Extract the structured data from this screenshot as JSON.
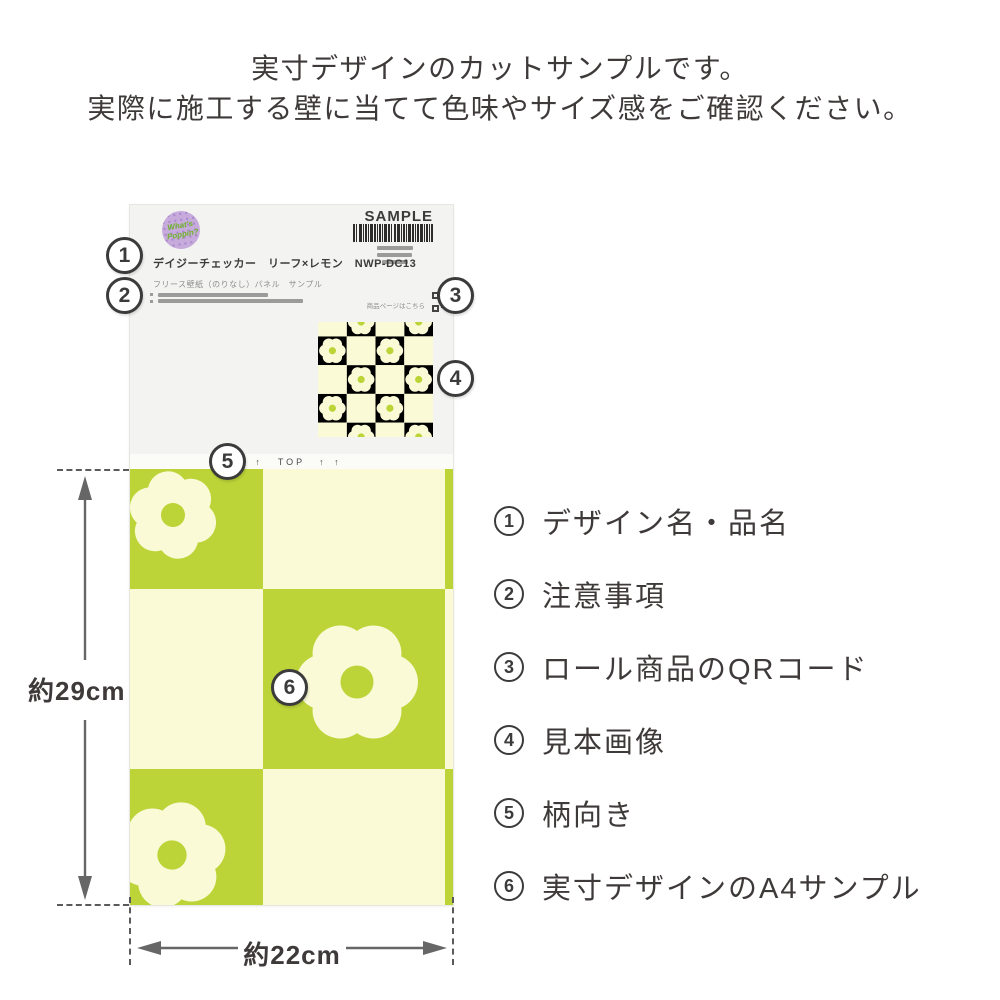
{
  "header": {
    "line1": "実寸デザインのカットサンプルです。",
    "line2": "実際に施工する壁に当てて色味やサイズ感をご確認ください。"
  },
  "label": {
    "brand": "What's Poppin?",
    "sample_text": "SAMPLE",
    "title": "デイジーチェッカー　リーフ×レモン　NWP-DC13",
    "subtitle": "フリース壁紙（のりなし）パネル　サンプル",
    "qr_caption": "商品ページはこちら",
    "top_arrows": "↑ ↑",
    "top_label": "TOP"
  },
  "callouts": [
    "1",
    "2",
    "3",
    "4",
    "5",
    "6"
  ],
  "legend": {
    "items": [
      {
        "num": "1",
        "label": "デザイン名・品名"
      },
      {
        "num": "2",
        "label": "注意事項"
      },
      {
        "num": "3",
        "label": "ロール商品のQRコード"
      },
      {
        "num": "4",
        "label": "見本画像"
      },
      {
        "num": "5",
        "label": "柄向き"
      },
      {
        "num": "6",
        "label": "実寸デザインのA4サンプル"
      }
    ]
  },
  "dimensions": {
    "height_label": "約29cm",
    "width_label": "約22cm"
  },
  "colors": {
    "green": "#bcd438",
    "cream": "#fafad6",
    "ink": "#3e3a39",
    "paper": "#f3f3f1",
    "strip": "#fbfbf8",
    "bar_gray": "#9b9b9b",
    "dim_gray": "#666666",
    "badge_bg": "#c7abdc",
    "badge_text": "#6fb32a"
  }
}
